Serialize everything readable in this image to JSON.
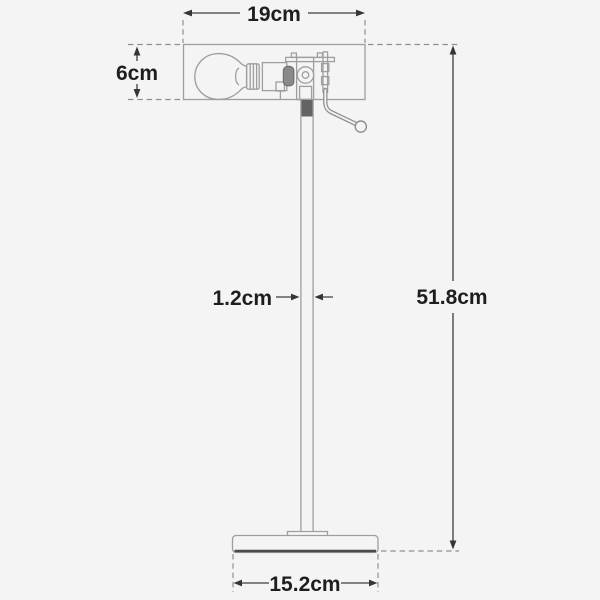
{
  "diagram": {
    "type": "technical-dimension-drawing",
    "labels": {
      "head_width": "19cm",
      "head_height": "6cm",
      "pole_diameter": "1.2cm",
      "overall_height": "51.8cm",
      "base_width": "15.2cm"
    },
    "colors": {
      "background": "#f4f4f4",
      "lamp_outline": "#9e9e9e",
      "dimension_line": "#3e3e3e",
      "label_text": "#1e1e1e",
      "dashed_extension": "#8f8f8f",
      "base_bottom_accent": "#4b4b4b",
      "pole_joint_fill": "#636363"
    }
  }
}
